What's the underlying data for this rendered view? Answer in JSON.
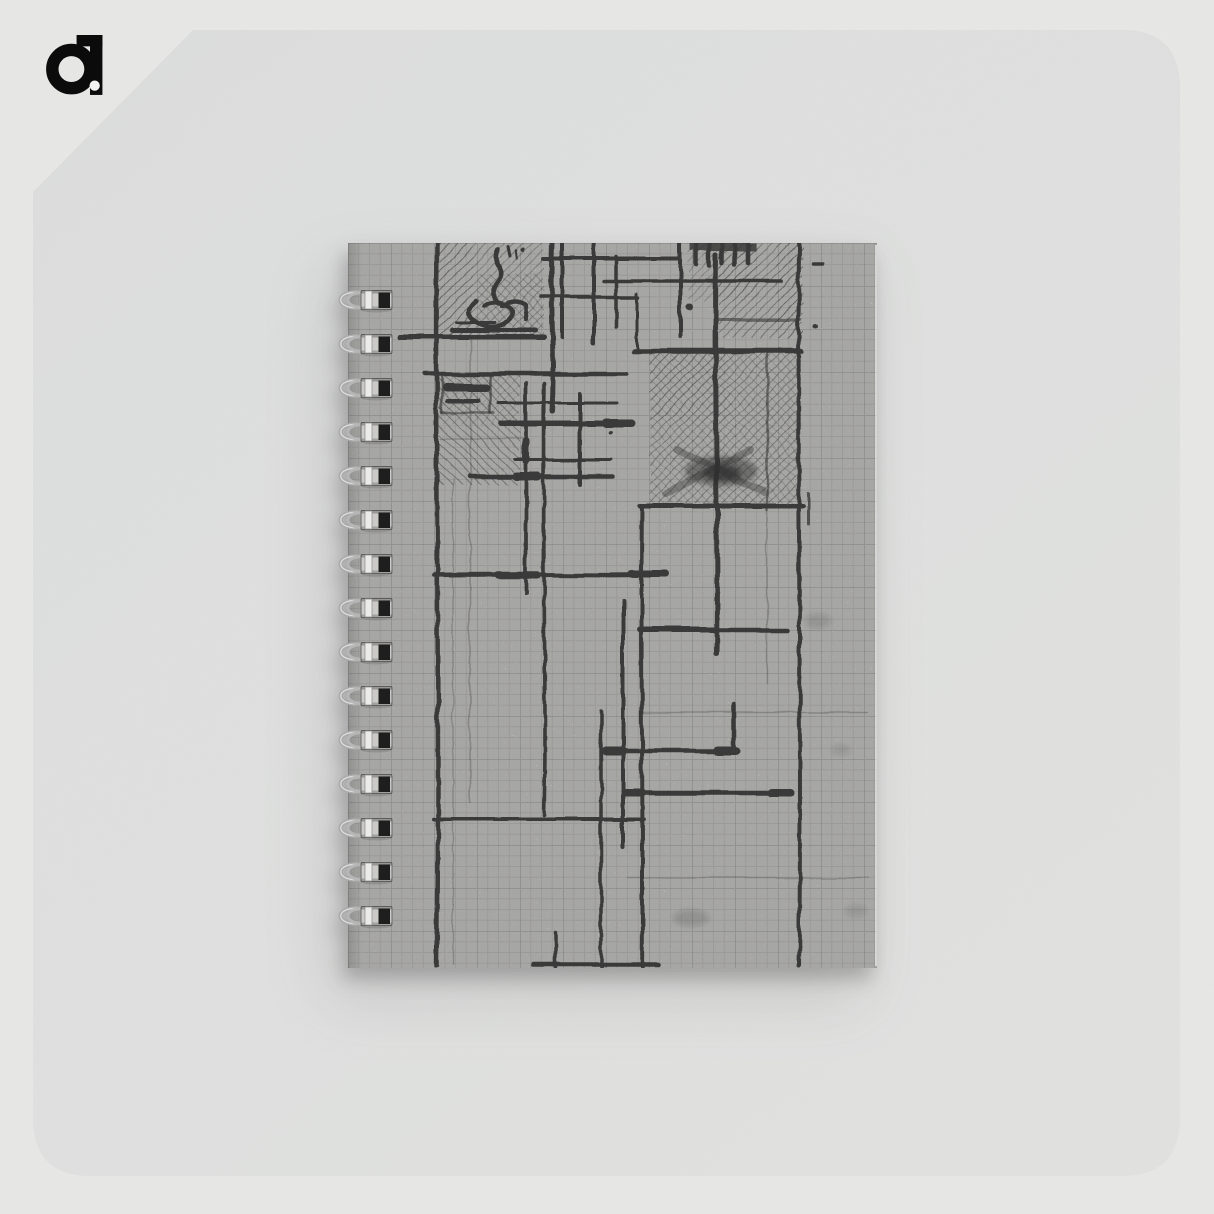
{
  "scene": {
    "background_color": "#f4f4f3",
    "card_color": "#e8e9e9",
    "card_color_end": "#edeeec"
  },
  "logo": {
    "text": "a.",
    "color": "#0b0b0b"
  },
  "notebook": {
    "alt": "Spiral notebook with a black and white abstract pencil sketch cover of intersecting bold lines and hatched squares drawn on graph paper",
    "cover_color": "#f0efed",
    "sketch_color": "#2f2f2f",
    "binding": {
      "side": "left",
      "ring_count": 15,
      "wire_color": "#a9a9a9"
    }
  }
}
